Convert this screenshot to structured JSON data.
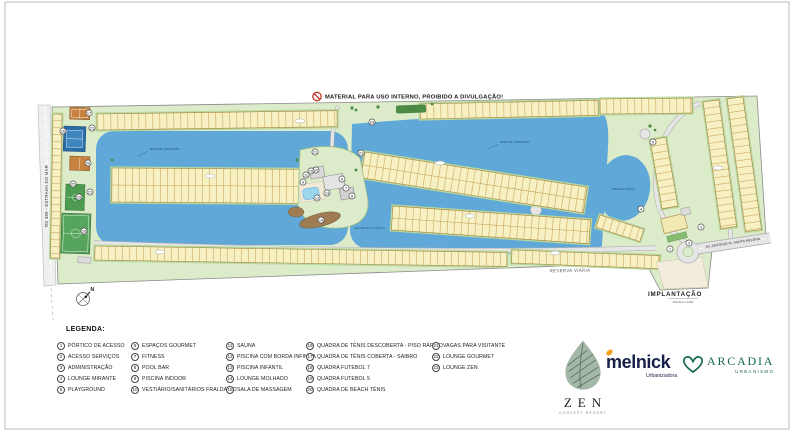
{
  "warning": {
    "text": "MATERIAL PARA USO INTERNO, PROIBIDO A DIVULGAÇÃO!"
  },
  "map": {
    "road_left_label": "RS 389 - ESTRADA DO MAR",
    "road_right_label": "AV. ANTONIO M. SANTA HELENA",
    "road_bottom_label": "RESERVA VIÁRIA",
    "water_label": "ESPELHO D'ÁGUA",
    "wall_label": "MURO DE CONTENÇÃO",
    "north_label": "N",
    "sheet_title": "IMPLANTAÇÃO",
    "sheet_subtitle": "ESCALA 1:1000",
    "markers": [
      {
        "n": "1",
        "x": 670,
        "y": 249
      },
      {
        "n": "2",
        "x": 689,
        "y": 243
      },
      {
        "n": "3",
        "x": 701,
        "y": 227
      },
      {
        "n": "4",
        "x": 641,
        "y": 209
      },
      {
        "n": "5",
        "x": 653,
        "y": 142
      },
      {
        "n": "6",
        "x": 342,
        "y": 179
      },
      {
        "n": "7",
        "x": 346,
        "y": 188
      },
      {
        "n": "8",
        "x": 352,
        "y": 196
      },
      {
        "n": "9",
        "x": 303,
        "y": 182
      },
      {
        "n": "10",
        "x": 316,
        "y": 170
      },
      {
        "n": "11",
        "x": 306,
        "y": 175
      },
      {
        "n": "12",
        "x": 317,
        "y": 198
      },
      {
        "n": "13",
        "x": 327,
        "y": 193
      },
      {
        "n": "14",
        "x": 321,
        "y": 220
      },
      {
        "n": "15",
        "x": 311,
        "y": 171
      },
      {
        "n": "16",
        "x": 63,
        "y": 131
      },
      {
        "n": "17",
        "x": 89,
        "y": 113
      },
      {
        "n": "18",
        "x": 84,
        "y": 231
      },
      {
        "n": "19",
        "x": 79,
        "y": 197
      },
      {
        "n": "20",
        "x": 88,
        "y": 163
      },
      {
        "n": "21",
        "x": 92,
        "y": 128
      },
      {
        "n": "21",
        "x": 90,
        "y": 192
      },
      {
        "n": "21",
        "x": 315,
        "y": 152
      },
      {
        "n": "21",
        "x": 361,
        "y": 153
      },
      {
        "n": "22",
        "x": 73,
        "y": 184
      },
      {
        "n": "23",
        "x": 372,
        "y": 122
      }
    ]
  },
  "legend": {
    "title": "LEGENDA:",
    "items": [
      {
        "n": "1",
        "label": "PÓRTICO DE ACESSO"
      },
      {
        "n": "2",
        "label": "ACESSO SERVIÇOS"
      },
      {
        "n": "3",
        "label": "ADMINISTRAÇÃO"
      },
      {
        "n": "4",
        "label": "LOUNGE MIRANTE"
      },
      {
        "n": "5",
        "label": "PLAYGROUND"
      },
      {
        "n": "6",
        "label": "ESPAÇOS GOURMET"
      },
      {
        "n": "7",
        "label": "FITNESS"
      },
      {
        "n": "8",
        "label": "POOL BAR"
      },
      {
        "n": "9",
        "label": "PISCINA INDOOR"
      },
      {
        "n": "10",
        "label": "VESTIÁRIO/SANITÁRIOS FRALDÁRIO"
      },
      {
        "n": "11",
        "label": "SAUNA"
      },
      {
        "n": "12",
        "label": "PISCINA COM BORDA INFINITA"
      },
      {
        "n": "13",
        "label": "PISCINA INFANTIL"
      },
      {
        "n": "14",
        "label": "LOUNGE MOLHADO"
      },
      {
        "n": "15",
        "label": "SALA DE MASSAGEM"
      },
      {
        "n": "16",
        "label": "QUADRA DE TÊNIS DESCOBERTA - PISO RÁPIDO"
      },
      {
        "n": "17",
        "label": "QUADRA DE TÊNIS COBERTA - SAIBRO"
      },
      {
        "n": "18",
        "label": "QUADRA FUTEBOL 7"
      },
      {
        "n": "19",
        "label": "QUADRA FUTEBOL 5"
      },
      {
        "n": "20",
        "label": "QUADRA DE BEACH TÊNIS"
      },
      {
        "n": "21",
        "label": "VAGAS PARA VISITANTE"
      },
      {
        "n": "22",
        "label": "LOUNGE GOURMET"
      },
      {
        "n": "23",
        "label": "LOUNGE ZEN"
      }
    ]
  },
  "logos": {
    "zen": {
      "name": "ZEN",
      "tagline": "CONCEPT RESORT"
    },
    "melnick": {
      "name": "melnick",
      "tagline": "Urbanizadora"
    },
    "arcadia": {
      "name": "ARCADIA",
      "tagline": "URBANISMO"
    }
  },
  "colors": {
    "water": "#5FA8D8",
    "lot": "#F6F0C2",
    "lot_line": "#C19A4F",
    "lot_border": "#A8853F",
    "green_base": "#DCEBC9",
    "green_edge": "#B7D8A0",
    "road": "#E6E6E6",
    "road_edge": "#AFAFAF",
    "warning_red": "#C0392B",
    "melnick_navy": "#172048",
    "melnick_orange": "#F6A01A",
    "arcadia_green": "#15684E",
    "zen_sage": "#A3B7A6"
  }
}
